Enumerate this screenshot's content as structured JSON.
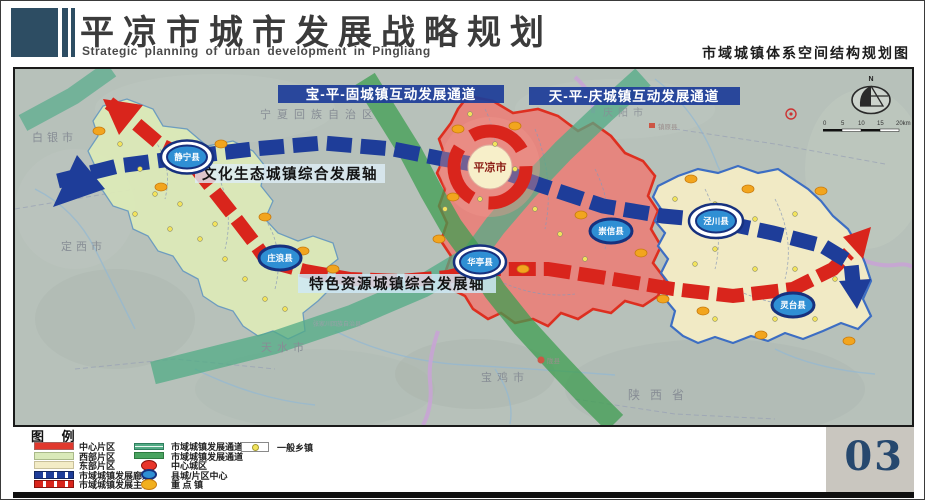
{
  "header": {
    "title": "平凉市城市发展战略规划",
    "subtitle": "Strategic planning of urban development in Pingliang",
    "sheet_title": "市域城镇体系空间结构规划图"
  },
  "map": {
    "compass_label": "N",
    "scale_ticks": [
      "0",
      "5",
      "10",
      "15",
      "20km"
    ],
    "corridor_labels": {
      "bao_ping_gu": "宝-平-固城镇互动发展通道",
      "tian_ping_qing": "天-平-庆城镇互动发展通道"
    },
    "axis_labels": {
      "culture_ecology": "文化生态城镇综合发展轴",
      "special_resource": "特色资源城镇综合发展轴"
    },
    "central_city": "平凉市",
    "counties": {
      "jingning": "静宁县",
      "zhuanglang": "庄浪县",
      "huating": "华亭县",
      "chongxin": "崇信县",
      "jingchuan": "泾川县",
      "lingtai": "灵台县"
    },
    "neighbors": {
      "ningxia": "宁夏回族自治区",
      "baiyin": "白银市",
      "dingxi": "定西市",
      "tianshui": "天水市",
      "baoji": "宝鸡市",
      "qingyang": "庆阳市",
      "shaanxi": "陕西省",
      "zhenyuan": "镇原县",
      "longxian": "陇县",
      "zhangjiachuan": "张家川回族自治县"
    }
  },
  "legend": {
    "title": "图 例",
    "col1": [
      {
        "label": "中心片区"
      },
      {
        "label": "西部片区"
      },
      {
        "label": "东部片区"
      },
      {
        "label": "市域城镇发展廊道"
      },
      {
        "label": "市域城镇发展主轴"
      }
    ],
    "col2": [
      {
        "label": "市域城镇发展通道"
      },
      {
        "label": "市域城镇发展通道"
      },
      {
        "label": "中心城区"
      },
      {
        "label": "县城/片区中心"
      },
      {
        "label": "重 点 镇"
      }
    ],
    "col3": [
      {
        "label": "一般乡镇"
      }
    ]
  },
  "page_number": "03",
  "colors": {
    "central_district": "#e8837c",
    "west_district": "#dceab8",
    "east_district": "#f3ecc6",
    "corridor_blue": "#1e3d99",
    "axis_red": "#d9251c",
    "channel_green": "#3f9e52",
    "channel_teal": "#52ab85",
    "accent_navy": "#2d4d63",
    "map_base": "#b7c1ba"
  }
}
